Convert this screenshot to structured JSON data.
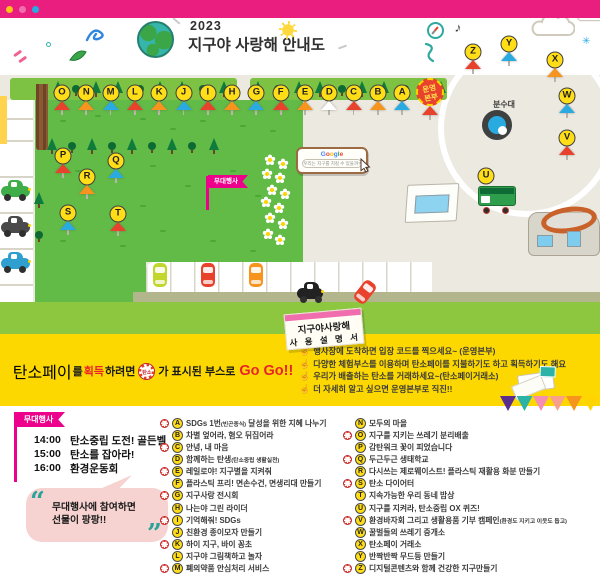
{
  "colors": {
    "top_bar": "#e91e7f",
    "pink": "#ec008c",
    "yellow_section": "#fcd800",
    "field_green": "#62bb46",
    "strip_green": "#8dc63f",
    "beige": "#ece9e0",
    "booth_yellow": "#ffdd17",
    "tent_red": "#e8412c",
    "tent_orange": "#f7941d",
    "tent_blue": "#29abe2",
    "tent_white": "#ffffff",
    "teal": "#2ab3a6",
    "go_red": "#e8232a"
  },
  "window_bar": {
    "dot_colors": [
      "#ffc317",
      "#f06eae",
      "#29abe2"
    ]
  },
  "header": {
    "year": "2023",
    "title": "지구야 사랑해 안내도"
  },
  "map": {
    "fountain_label": "분수대",
    "hq_badge_line1": "운영",
    "hq_badge_line2": "본부",
    "stage_flag": "무대행사",
    "google_bubble": {
      "logo": "Google",
      "query": "우리는 지구를 지킬 수 있을까?"
    },
    "top_booths": [
      {
        "letter": "O",
        "tent": "red"
      },
      {
        "letter": "N",
        "tent": "orange"
      },
      {
        "letter": "M",
        "tent": "blue"
      },
      {
        "letter": "L",
        "tent": "red"
      },
      {
        "letter": "K",
        "tent": "orange"
      },
      {
        "letter": "J",
        "tent": "blue"
      },
      {
        "letter": "I",
        "tent": "red"
      },
      {
        "letter": "H",
        "tent": "orange"
      },
      {
        "letter": "G",
        "tent": "blue"
      },
      {
        "letter": "F",
        "tent": "red"
      },
      {
        "letter": "E",
        "tent": "orange"
      },
      {
        "letter": "D",
        "tent": "white"
      },
      {
        "letter": "C",
        "tent": "red"
      },
      {
        "letter": "B",
        "tent": "orange"
      },
      {
        "letter": "A",
        "tent": "blue"
      }
    ],
    "field_booths": [
      {
        "letter": "P",
        "tent": "red"
      },
      {
        "letter": "Q",
        "tent": "blue"
      },
      {
        "letter": "R",
        "tent": "orange"
      },
      {
        "letter": "S",
        "tent": "blue"
      },
      {
        "letter": "T",
        "tent": "red"
      }
    ],
    "plaza_booths": [
      {
        "letter": "Z",
        "tent": "red"
      },
      {
        "letter": "Y",
        "tent": "blue"
      },
      {
        "letter": "X",
        "tent": "orange"
      },
      {
        "letter": "W",
        "tent": "blue"
      },
      {
        "letter": "V",
        "tent": "red"
      },
      {
        "letter": "U",
        "tent": "none"
      }
    ]
  },
  "carbon_banner": {
    "coin_label": "탄소",
    "segments": [
      {
        "text": "탄소페이",
        "style": "pink-lg"
      },
      {
        "text": "를 ",
        "style": "dark"
      },
      {
        "text": "획득",
        "style": "red"
      },
      {
        "text": "하려면 ",
        "style": "dark"
      },
      {
        "text": "",
        "style": "coin"
      },
      {
        "text": "가 표시된 부스로 ",
        "style": "dark"
      },
      {
        "text": "Go Go!!",
        "style": "red-lg"
      }
    ]
  },
  "manual": {
    "tag_line1": "지구야사랑해",
    "tag_line2": "사 용 설 명 서",
    "items": [
      "행사장에 도착하면 입장 코드를 찍으세요~ (운영본부)",
      "다양한 체험부스를 이용하며 탄소페이를 지불하기도 하고 획득하기도 해요",
      "우리가 배출하는 탄소를 거래하세요~(탄소페이거래소)",
      "더 자세히 알고 싶으면 운영본부로 직진!!"
    ]
  },
  "schedule": {
    "flag": "무대행사",
    "items": [
      {
        "time": "14:00",
        "label": "탄소중립 도전! 골든벨"
      },
      {
        "time": "15:00",
        "label": "탄소를 잡아라!"
      },
      {
        "time": "16:00",
        "label": "환경운동회"
      }
    ]
  },
  "bubble": {
    "line1": "무대행사에 참여하면",
    "line2": "선물이 팡팡!!"
  },
  "booth_list": {
    "left": [
      {
        "letter": "A",
        "coin": true,
        "segments": [
          {
            "text": "SDGs 1번"
          },
          {
            "text": "(빈곤종식)",
            "small": true
          },
          {
            "text": " 달성을 위한 지혜 나누기"
          }
        ]
      },
      {
        "letter": "B",
        "coin": false,
        "segments": [
          {
            "text": "차별 엎어라, 혐오 뒤집어라"
          }
        ]
      },
      {
        "letter": "C",
        "coin": true,
        "segments": [
          {
            "text": "안녕, 내 마음"
          }
        ]
      },
      {
        "letter": "D",
        "coin": false,
        "segments": [
          {
            "text": "함께하는 탄생"
          },
          {
            "text": "(탄소중립 생활실천)",
            "small": true
          }
        ]
      },
      {
        "letter": "E",
        "coin": true,
        "segments": [
          {
            "text": "레일로야! 지구별을 지켜줘"
          }
        ]
      },
      {
        "letter": "F",
        "coin": false,
        "segments": [
          {
            "text": "플라스틱 프리! 면손수건, 면생리대 만들기"
          }
        ]
      },
      {
        "letter": "G",
        "coin": true,
        "segments": [
          {
            "text": "지구사랑 전시회"
          }
        ]
      },
      {
        "letter": "H",
        "coin": false,
        "segments": [
          {
            "text": "나는야 그린 라이더"
          }
        ]
      },
      {
        "letter": "I",
        "coin": true,
        "segments": [
          {
            "text": "기억해줘! SDGs"
          }
        ]
      },
      {
        "letter": "J",
        "coin": false,
        "segments": [
          {
            "text": "친환경 종이모자 만들기"
          }
        ]
      },
      {
        "letter": "K",
        "coin": true,
        "segments": [
          {
            "text": "하이 지구, 바이 꽁초"
          }
        ]
      },
      {
        "letter": "L",
        "coin": false,
        "segments": [
          {
            "text": "지구야 그림책하고 놀자"
          }
        ]
      },
      {
        "letter": "M",
        "coin": true,
        "segments": [
          {
            "text": "폐의약품 안심처리 서비스"
          }
        ]
      }
    ],
    "right": [
      {
        "letter": "N",
        "coin": false,
        "segments": [
          {
            "text": "모두의 마을"
          }
        ]
      },
      {
        "letter": "O",
        "coin": true,
        "segments": [
          {
            "text": "지구를 지키는 쓰레기 분리배출"
          }
        ]
      },
      {
        "letter": "P",
        "coin": false,
        "segments": [
          {
            "text": "감탄워크 꽃이 피었습니다"
          }
        ]
      },
      {
        "letter": "Q",
        "coin": true,
        "segments": [
          {
            "text": "두근두근 생태학교"
          }
        ]
      },
      {
        "letter": "R",
        "coin": false,
        "segments": [
          {
            "text": "다시쓰는 제로웨이스트! 플라스틱 재활용 화분 만들기"
          }
        ]
      },
      {
        "letter": "S",
        "coin": true,
        "segments": [
          {
            "text": "탄소 다이어터"
          }
        ]
      },
      {
        "letter": "T",
        "coin": false,
        "segments": [
          {
            "text": "지속가능한 우리 동네 밥상"
          }
        ]
      },
      {
        "letter": "U",
        "coin": false,
        "segments": [
          {
            "text": "지구를 지켜라, 탄소중립 OX 퀴즈!"
          }
        ]
      },
      {
        "letter": "V",
        "coin": true,
        "segments": [
          {
            "text": "환경바자회 그리고 생활용품 기부 캠페인"
          },
          {
            "text": "(환경도 지키고 이웃도 돕고)",
            "small": true
          }
        ]
      },
      {
        "letter": "W",
        "coin": false,
        "segments": [
          {
            "text": "꿀벌들의 쓰레기 중개소"
          }
        ]
      },
      {
        "letter": "X",
        "coin": false,
        "segments": [
          {
            "text": "탄소페이 거래소"
          }
        ]
      },
      {
        "letter": "Y",
        "coin": false,
        "segments": [
          {
            "text": "반짝반짝 무드등 만들기"
          }
        ]
      },
      {
        "letter": "Z",
        "coin": true,
        "segments": [
          {
            "text": "디지털콘텐츠와 함께 건강한 지구만들기"
          }
        ]
      }
    ]
  }
}
